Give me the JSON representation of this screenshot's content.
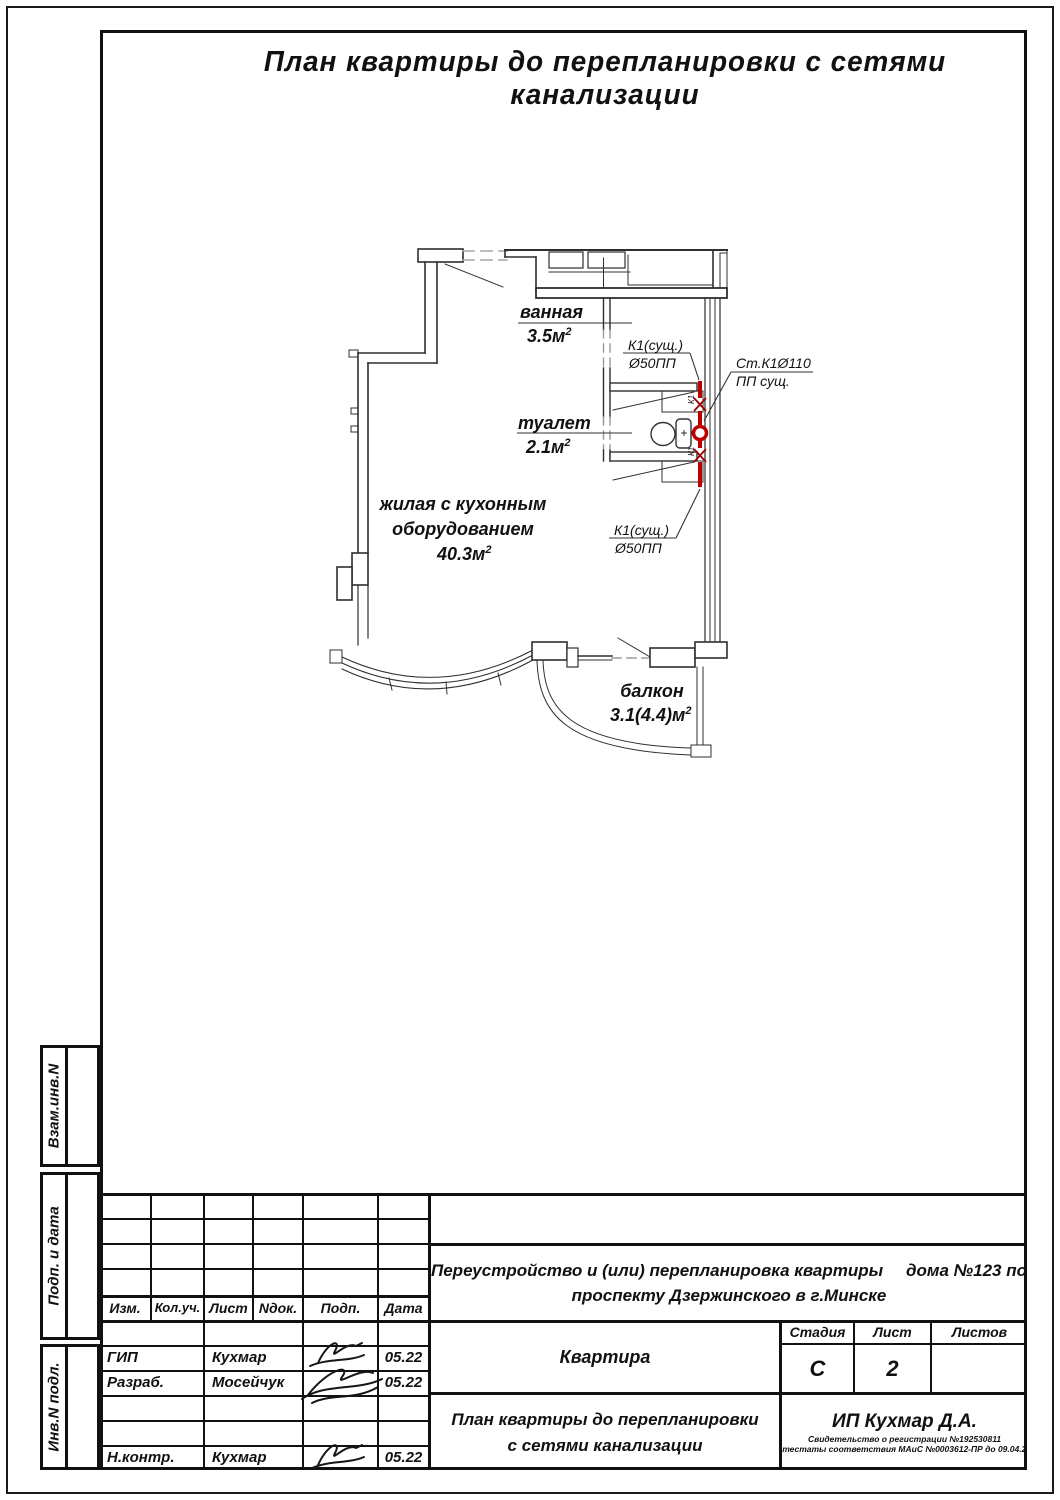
{
  "page": {
    "title": "План квартиры до перепланировки с сетями канализации"
  },
  "plan": {
    "rooms": {
      "bath": {
        "name": "ванная",
        "area": "3.5м",
        "sup": "2"
      },
      "wc": {
        "name": "туалет",
        "area": "2.1м",
        "sup": "2"
      },
      "living": {
        "line1": "жилая с кухонным",
        "line2": "оборудованием",
        "area": "40.3м",
        "sup": "2"
      },
      "balcony": {
        "name": "балкон",
        "area": "3.1(4.4)м",
        "sup": "2"
      }
    },
    "annotations": {
      "k1_top_line1": "К1(сущ.)",
      "k1_top_line2": "Ø50ПП",
      "stack_line1": "Ст.К1Ø110",
      "stack_line2": "ПП сущ.",
      "k1_bottom_line1": "К1(сущ.)",
      "k1_bottom_line2": "Ø50ПП",
      "pipe_mark": "К1"
    },
    "colors": {
      "pipe": "#c00000",
      "wall": "#2f2f2f"
    }
  },
  "sidebar": {
    "cell1": "Взам.инв.N",
    "cell2": "Подп. и дата",
    "cell3": "Инв.N подл."
  },
  "titleblock": {
    "rev_headers": [
      "Изм.",
      "Кол.уч.",
      "Лист",
      "Nдок.",
      "Подп.",
      "Дата"
    ],
    "sign_rows": [
      {
        "role": "ГИП",
        "name": "Кухмар",
        "date": "05.22"
      },
      {
        "role": "Разраб.",
        "name": "Мосейчук",
        "date": "05.22"
      },
      {
        "role": "Н.контр.",
        "name": "Кухмар",
        "date": "05.22"
      }
    ],
    "object_line1a": "Переустройство и (или) перепланировка квартиры",
    "object_line1b": "дома №123 по",
    "object_line2": "проспекту Дзержинского в г.Минске",
    "doc_name": "Квартира",
    "stage_label": "Стадия",
    "sheet_label": "Лист",
    "sheets_label": "Листов",
    "stage_value": "С",
    "sheet_value": "2",
    "sheets_value": "",
    "sheet_title_line1": "План квартиры до перепланировки",
    "sheet_title_line2": "с сетями канализации",
    "firm": "ИП Кухмар Д.А.",
    "firm_line2": "Свидетельство о регистрации №192530811",
    "firm_line3": "Аттестаты соответствия МАиС №0003612-ПР до 09.04.2026"
  }
}
